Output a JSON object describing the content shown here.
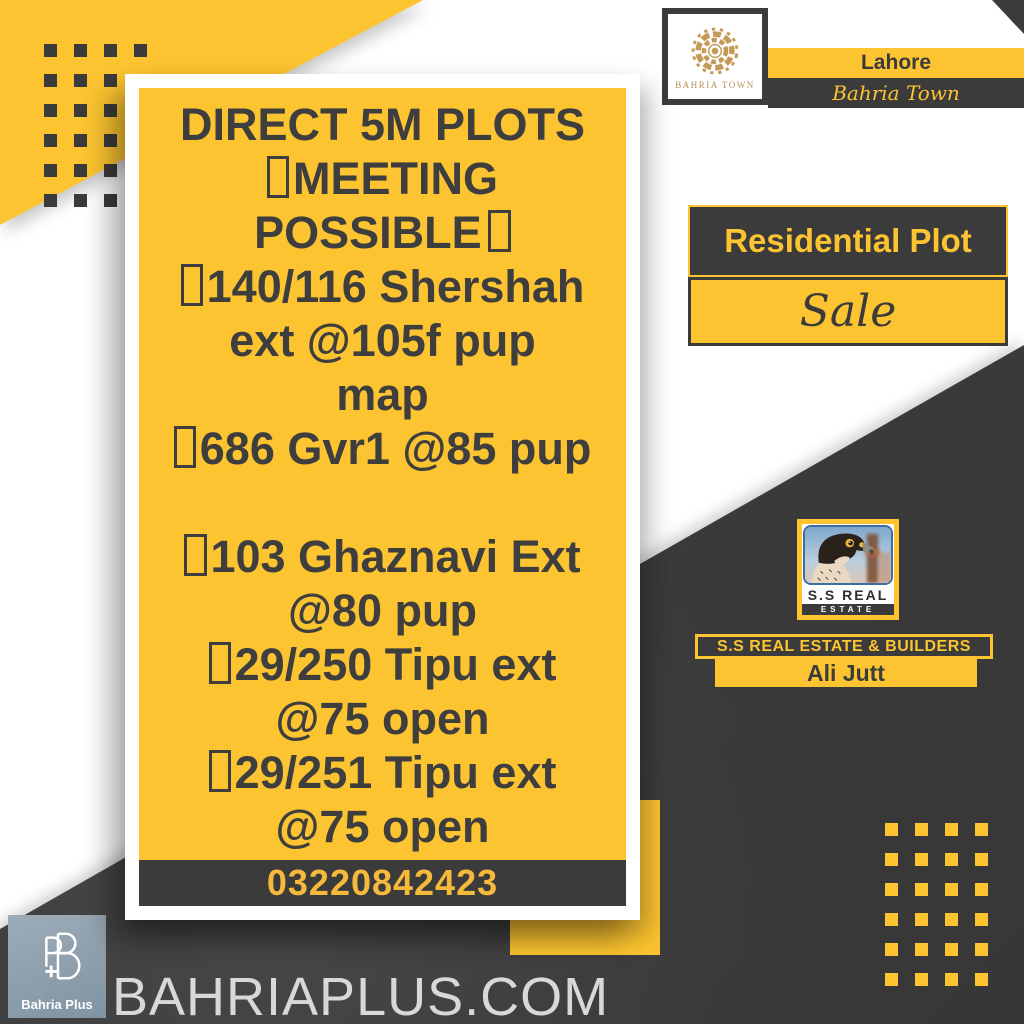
{
  "brand": {
    "logo_caption": "BAHRIA TOWN",
    "city": "Lahore",
    "name": "Bahria Town"
  },
  "listing": {
    "category": "Residential Plot",
    "action": "Sale"
  },
  "card": {
    "lines": [
      {
        "text": "DIRECT 5M PLOTS",
        "box_before": false,
        "box_after": false
      },
      {
        "text": "MEETING",
        "box_before": true,
        "box_after": false
      },
      {
        "text": "POSSIBLE",
        "box_before": false,
        "box_after": true
      },
      {
        "text": "140/116 Shershah",
        "box_before": true,
        "box_after": false
      },
      {
        "text": "ext @105f pup",
        "box_before": false,
        "box_after": false
      },
      {
        "text": "map",
        "box_before": false,
        "box_after": false
      },
      {
        "text": "686 Gvr1 @85 pup",
        "box_before": true,
        "box_after": false
      },
      {
        "text": "",
        "box_before": false,
        "box_after": false
      },
      {
        "text": "103 Ghaznavi Ext",
        "box_before": true,
        "box_after": false
      },
      {
        "text": "@80 pup",
        "box_before": false,
        "box_after": false
      },
      {
        "text": "29/250 Tipu ext",
        "box_before": true,
        "box_after": false
      },
      {
        "text": "@75 open",
        "box_before": false,
        "box_after": false
      },
      {
        "text": "29/251 Tipu ext",
        "box_before": true,
        "box_after": false
      },
      {
        "text": "@75 open",
        "box_before": false,
        "box_after": false
      }
    ],
    "phone": "03220842423"
  },
  "agency": {
    "logo_line1": "S.S REAL",
    "logo_line2": "ESTATE",
    "banner": "S.S REAL ESTATE & BUILDERS",
    "agent": "Ali Jutt"
  },
  "footer": {
    "logo_label": "Bahria Plus",
    "website": "BAHRIAPLUS.COM"
  },
  "colors": {
    "accent_yellow": "#FCC430",
    "dark_charcoal": "#3B3B3B",
    "brand_gold": "#C49A58",
    "phone_text": "#F5B93C",
    "website_text": "#D8D8D8"
  }
}
